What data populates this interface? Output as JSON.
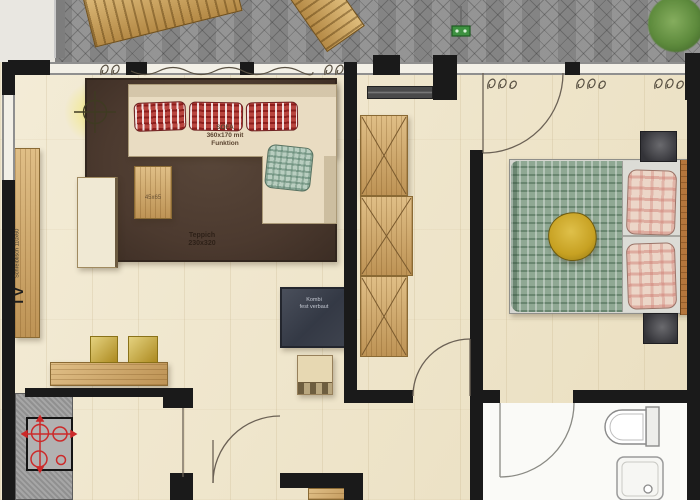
{
  "plan": {
    "labels": {
      "sofa": {
        "l1": "SOFA",
        "l2": "360x170 mit",
        "l3": "Funktion"
      },
      "coffee_table": {
        "size": "45x65"
      },
      "rug": {
        "l1": "Teppich",
        "l2": "230x320"
      },
      "desk": {
        "tv": "TV",
        "l1": "Schreibtisch",
        "l2": "110x60"
      },
      "hall_cabinet": {
        "l1": "Kombi",
        "l2": "fest verbaut"
      }
    },
    "palette": {
      "wall": "#1a1a1a",
      "floor": "#f0e6ca",
      "paver": "#8e8e8e",
      "rug": "#4c3a2f",
      "sofa": "#e9dcc2",
      "cushion_red": "#b8453f",
      "cushion_green": "#b9cec0",
      "wood": "#cfa463",
      "stool": "#c9a42c",
      "counter": "#9c9c9c",
      "stove": "#cc2a2a",
      "blanket": "#8fa893",
      "pillow_yellow": "#c7a122",
      "pillow_pink": "#ecd6c8",
      "dark_furniture": "#3e434e",
      "bath": "#fafaf7",
      "plant": "#5d8a3c",
      "glow": "#f3e878"
    },
    "icons": [
      "lamp-icon",
      "stove-icon",
      "toilet-icon",
      "shower-icon",
      "plant-icon",
      "curtain-icon",
      "wardrobe-x-icon",
      "faucet-icon",
      "door-arc"
    ]
  }
}
